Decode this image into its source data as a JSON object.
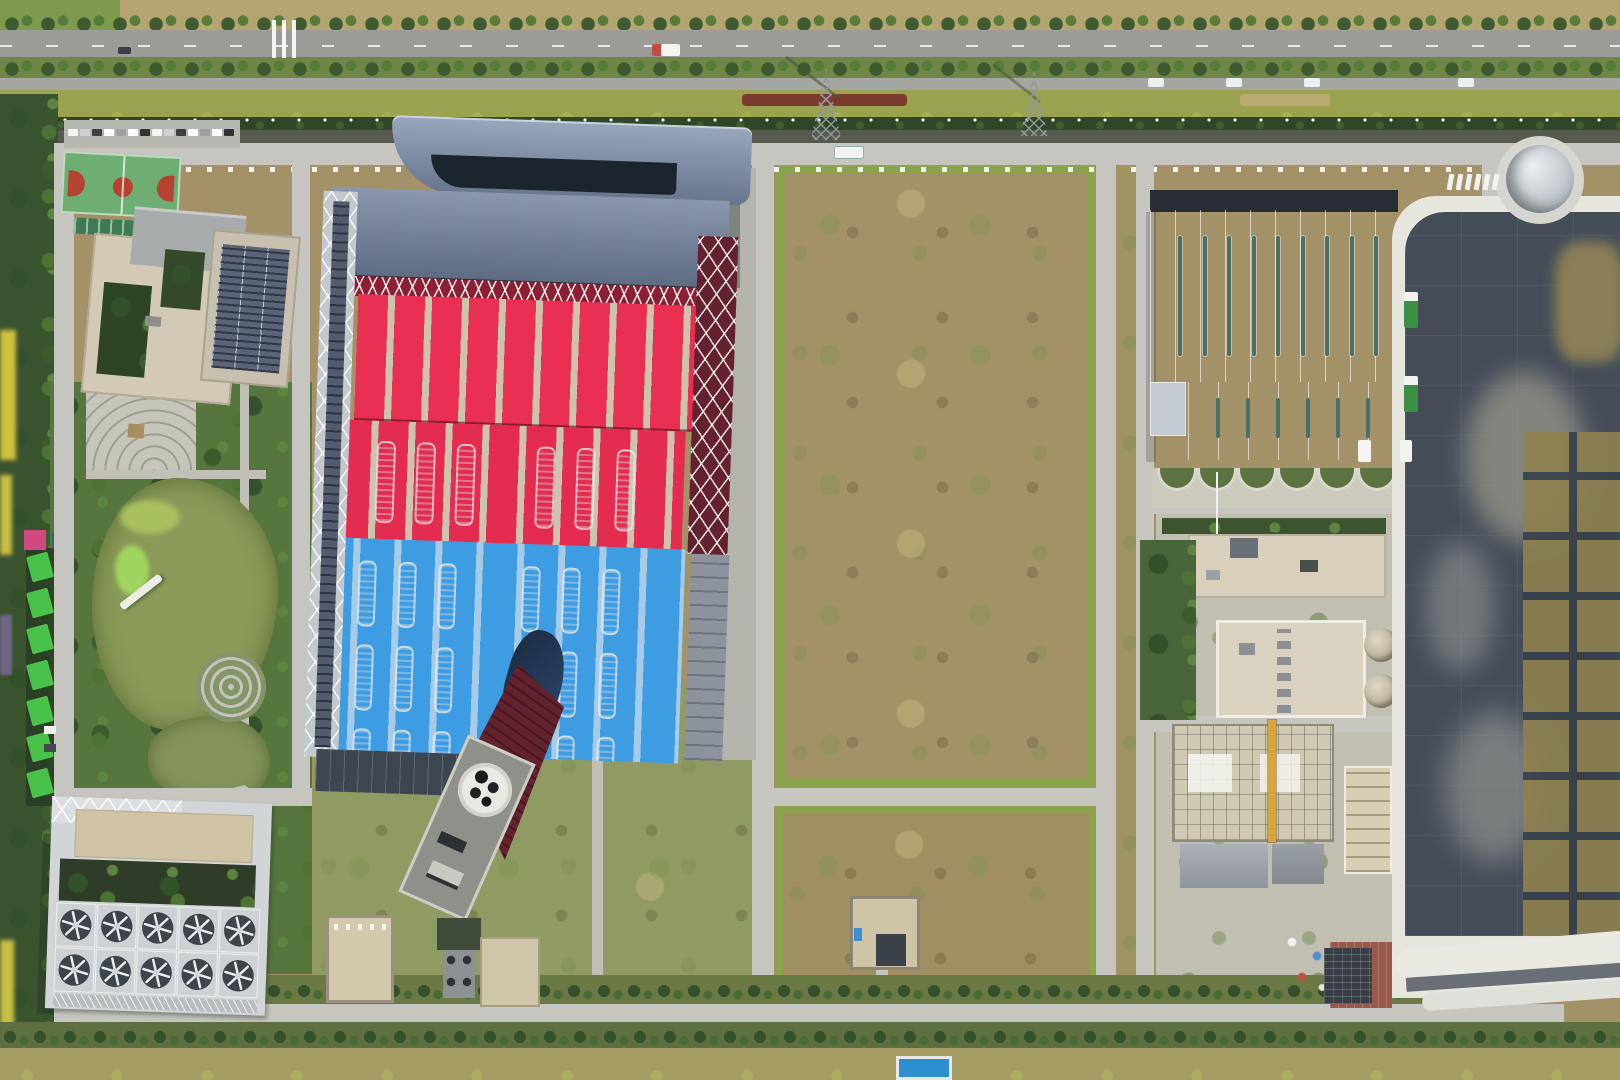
{
  "scene": {
    "title": "Aerial top-down drone photograph of an industrial power-plant campus",
    "time_of_day": "midday, hard small shadows",
    "areas": {
      "top": "tree-lined dual carriageway highway with green verge, hedge and two lattice pylons",
      "left": "office building with basketball court, landscaped park with olive-green pond, paths and round plaza",
      "center": "main plant hall with bright red and blue striped roofs, glass north canopies, roof vent slots, tilted flue building with round stack openings",
      "center_right": "large bare brown dirt field framed by grass strips and internal roads, one small flat-roof utility building",
      "right": "light grey warehouse with skylight slits, beige process buildings with round tanks, construction yard with yellow crane, rows of green trucks",
      "far_right": "large dark geomembrane-lined basin with white perimeter road, grey silt patches and olive drying cells, round grey tank at its top corner",
      "bottom_left": "bank of mechanical draft cooling towers: two rows of five fans"
    }
  },
  "palette": {
    "red_roof": "#e93053",
    "red_stripe": "#ccc4ae",
    "red_dark": "#8c1f33",
    "blue_roof": "#3e9ce2",
    "blue_stripe": "#a6cbe8",
    "glass": "#8leave094ad",
    "glass_top": "#97a7bd",
    "glass_bottom": "#66748c",
    "maroon": "#64222e",
    "navy_flue": "#223850",
    "warehouse": "#c8d1d8",
    "skylight": "#4a6f66",
    "beige": "#d7cfb8",
    "office_beige": "#d2cab6",
    "office_gray": "#a8abab",
    "solar": "#5b6478",
    "road": "#c6c5bf",
    "highway": "#9b9b97",
    "white_road": "#e6e6df",
    "grass": "#8ca24d",
    "verge": "#9aa24e",
    "tree": "#3f5a2f",
    "park_base": "#57763e",
    "pond_olive": "#8a9a58",
    "dirt": "#a39268",
    "dark_pond": "#454d59",
    "pond_brown": "#8c8150",
    "cooling_frame": "#d2d5d8",
    "fan_dark": "#3d444c",
    "tank": "#ccd2d5",
    "crane_yellow": "#d9a440",
    "court_green": "#6fae72",
    "court_red": "#b5432f",
    "apron_red": "#9a5a4a",
    "pool_blue": "#2e8fd0",
    "flower_yellow": "#cdc23c",
    "truck_green": "#3d8f46"
  },
  "counts": {
    "cooling_fan_rows": 2,
    "cooling_fan_cols": 5,
    "red_roof_vents": 6,
    "blue_vent_rows": 3,
    "blue_vents_per_row": 6,
    "warehouse_skylights": 9,
    "annex_skylights": 6,
    "planter_arches": 6,
    "parking_cars": 14,
    "shelter_panels": 7,
    "crosswalk_bars": 6,
    "upper_road_trucks": 2,
    "lower_yard_trucks": 5,
    "median_parked_vans": 4
  }
}
